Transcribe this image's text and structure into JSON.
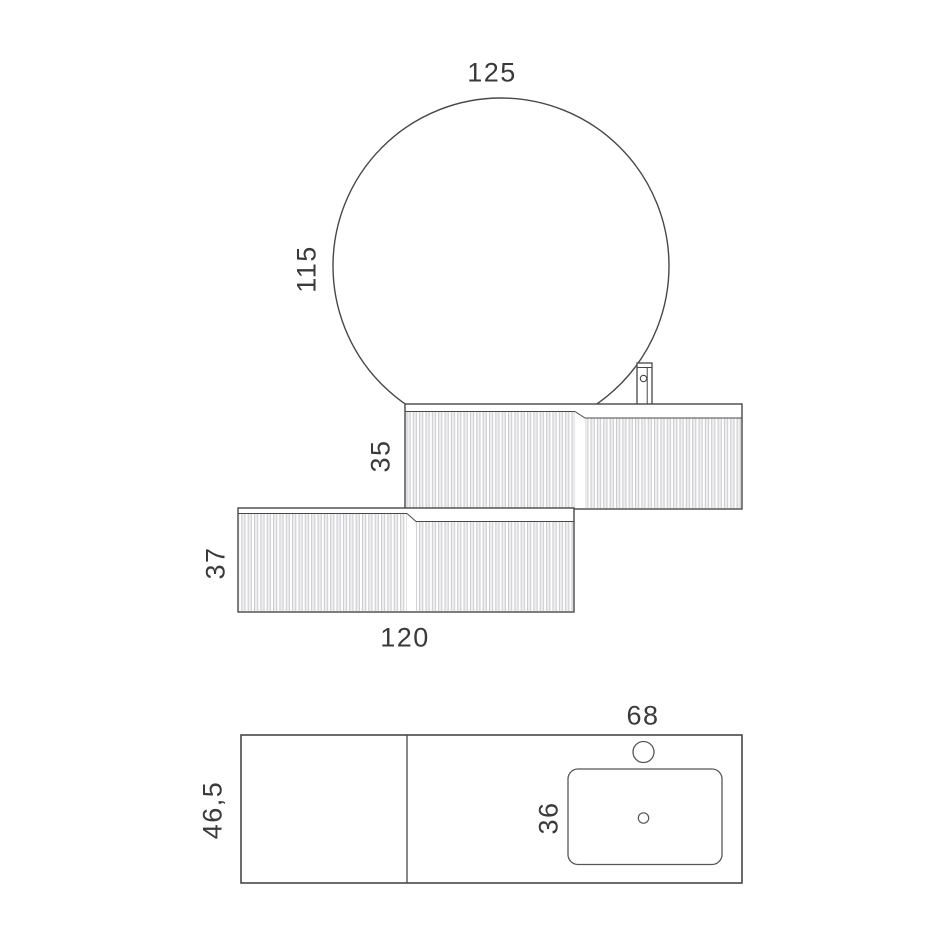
{
  "diagram": {
    "type": "bathroom-vanity-technical-drawing",
    "views": {
      "front_view": {
        "mirror": {
          "shape": "circle",
          "width_label": "125",
          "height_label": "115"
        },
        "washbasin_cabinet": {
          "height_label": "35",
          "texture": "fluted",
          "has_faucet": true
        },
        "drawer_cabinet": {
          "height_label": "37",
          "width_label": "120",
          "texture": "fluted"
        }
      },
      "top_view": {
        "countertop_depth_label": "46,5",
        "basin_section_width_label": "68",
        "basin_depth_label": "36",
        "features": [
          "divider-line",
          "basin-outline",
          "faucet-hole",
          "drain-hole"
        ]
      }
    },
    "dimensions": {
      "mirror_width": "125",
      "mirror_height": "115",
      "washbasin_cabinet_height": "35",
      "drawer_cabinet_height": "37",
      "drawer_cabinet_width": "120",
      "basin_section_width": "68",
      "countertop_depth": "46,5",
      "basin_depth": "36"
    },
    "colors": {
      "background": "#ffffff",
      "line": "#484848",
      "text": "#3a3a3a",
      "flute_dark": "#c9c9cc",
      "flute_light": "#efeff1"
    }
  }
}
